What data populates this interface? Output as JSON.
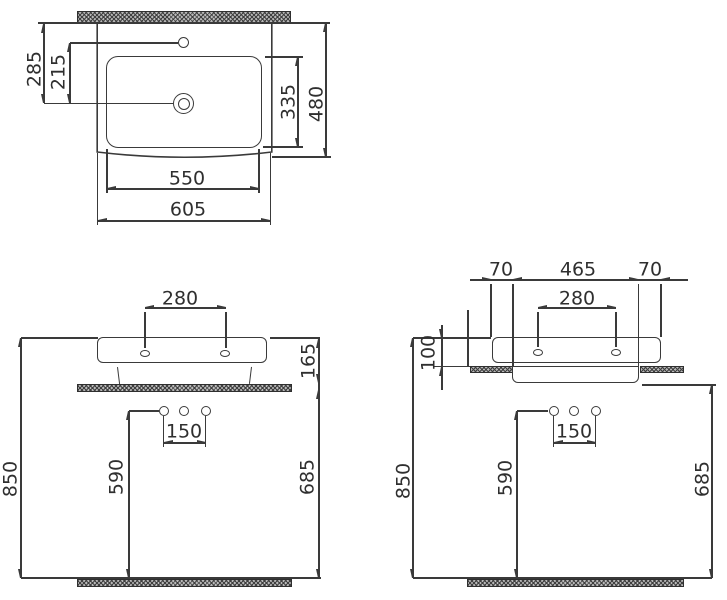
{
  "drawing": {
    "type": "washbasin-installation-dimensions",
    "colors": {
      "line": "#3a3a3a",
      "text": "#2f2f2f",
      "hatch": "#b9b9b9",
      "background": "#ffffff"
    }
  },
  "views": {
    "top": {
      "dims": {
        "left_outer": "285",
        "left_inner": "215",
        "right_inner": "335",
        "right_outer": "480",
        "bottom_inner": "550",
        "bottom_outer": "605"
      }
    },
    "front": {
      "dims": {
        "tap_holes_spacing": "280",
        "rim_height": "165",
        "outlet_spacing": "150",
        "outlet_height": "590",
        "rim_from_floor": "850",
        "clearance_under": "685"
      }
    },
    "side": {
      "dims": {
        "left_overhang": "70",
        "recess_width": "465",
        "right_overhang": "70",
        "tap_holes_spacing": "280",
        "rim_above_counter": "100",
        "outlet_spacing": "150",
        "outlet_height": "590",
        "rim_from_floor": "850",
        "counter_clearance": "685"
      }
    }
  }
}
